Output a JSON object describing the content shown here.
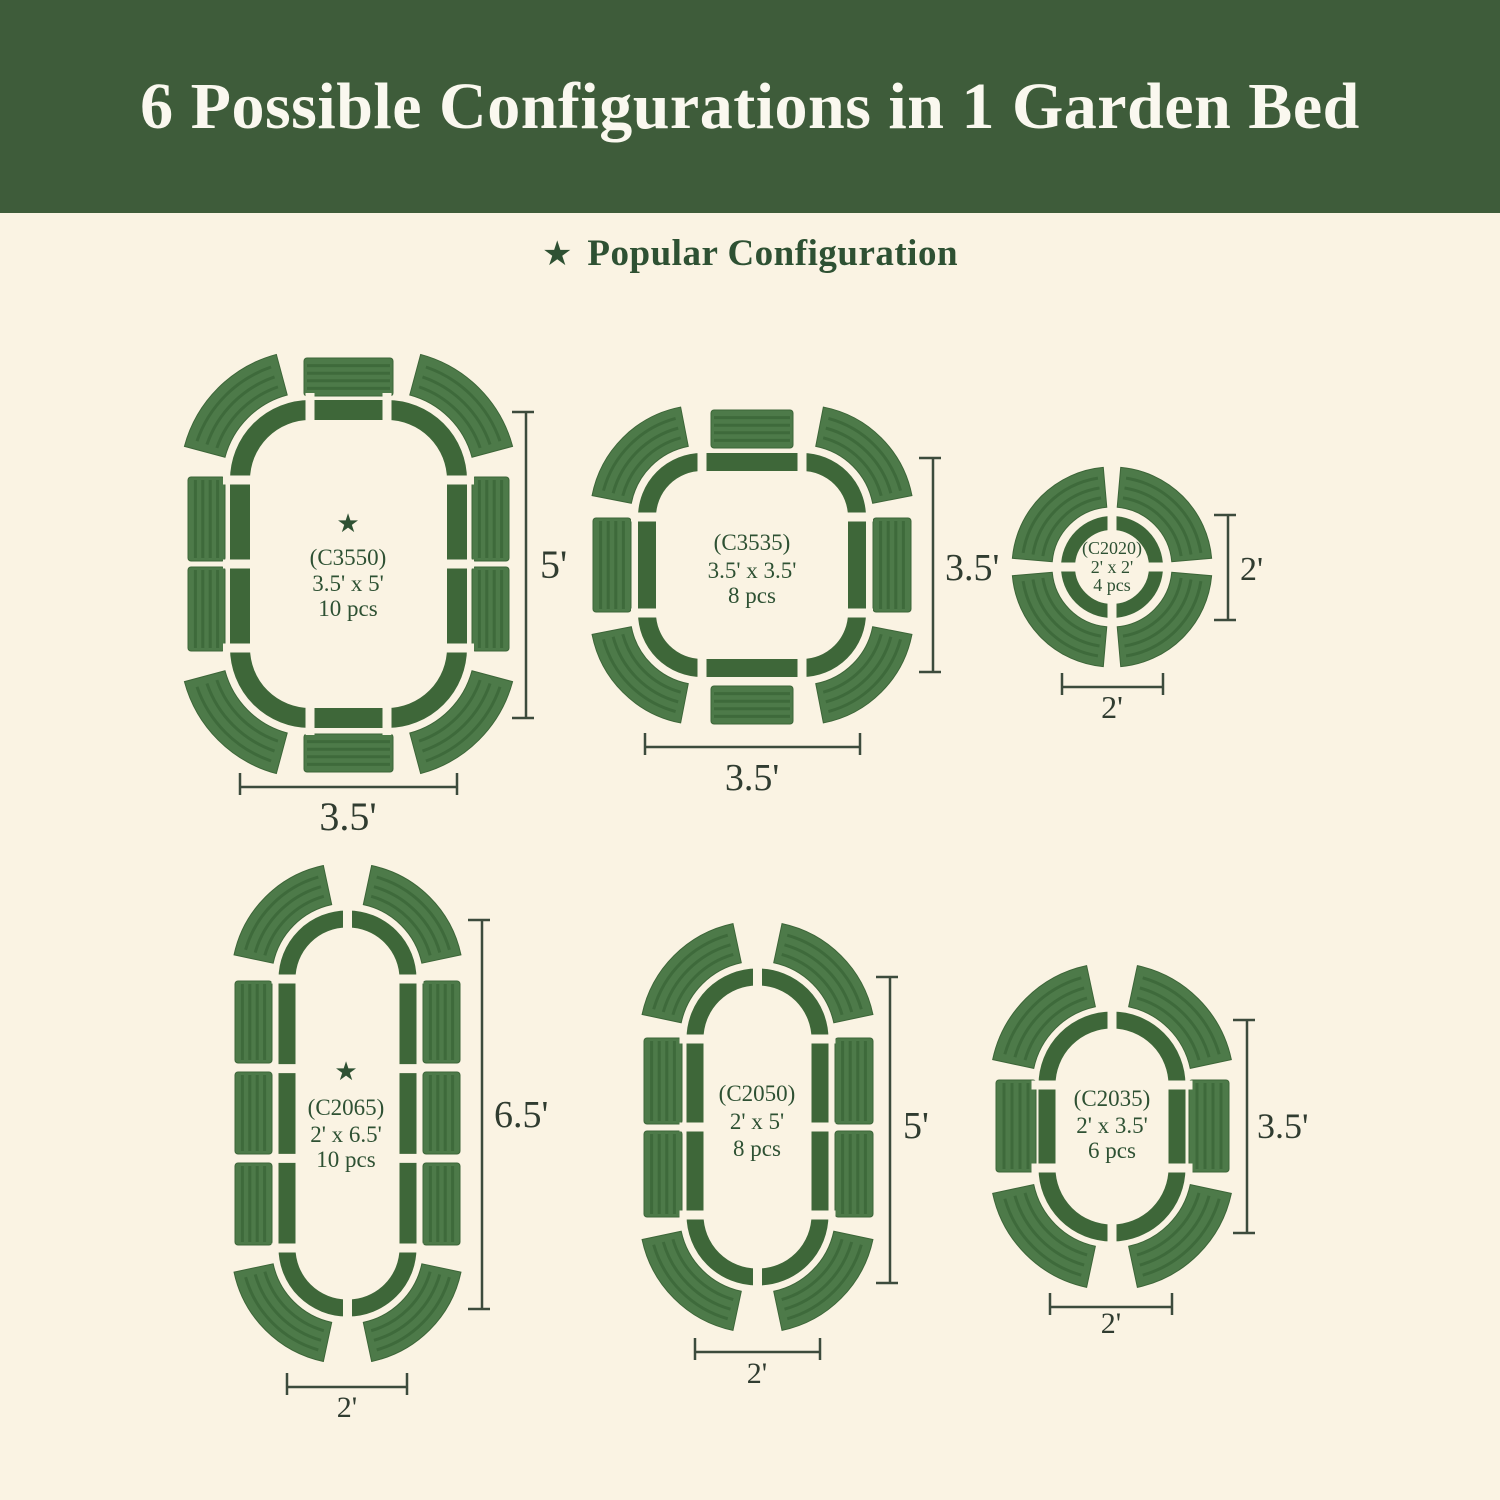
{
  "header": {
    "title": "6 Possible Configurations in 1 Garden Bed"
  },
  "legend": {
    "star_icon": "★",
    "label": "Popular Configuration"
  },
  "configs": [
    {
      "code": "(C3550)",
      "size": "3.5' x 5'",
      "pieces": "10 pcs",
      "popular": true,
      "height_dim": "5'",
      "width_dim": "3.5'"
    },
    {
      "code": "(C3535)",
      "size": "3.5' x 3.5'",
      "pieces": "8 pcs",
      "popular": false,
      "height_dim": "3.5'",
      "width_dim": "3.5'"
    },
    {
      "code": "(C2020)",
      "size": "2' x 2'",
      "pieces": "4 pcs",
      "popular": false,
      "height_dim": "2'",
      "width_dim": "2'"
    },
    {
      "code": "(C2065)",
      "size": "2' x 6.5'",
      "pieces": "10 pcs",
      "popular": true,
      "height_dim": "6.5'",
      "width_dim": "2'"
    },
    {
      "code": "(C2050)",
      "size": "2' x 5'",
      "pieces": "8 pcs",
      "popular": false,
      "height_dim": "5'",
      "width_dim": "2'"
    },
    {
      "code": "(C2035)",
      "size": "2' x 3.5'",
      "pieces": "6 pcs",
      "popular": false,
      "height_dim": "3.5'",
      "width_dim": "2'"
    }
  ],
  "colors": {
    "header_bg": "#3e5c3a",
    "header_text": "#faf8ef",
    "background": "#faf3e3",
    "bed_outline": "#3e6739",
    "panel": "#4d7a49",
    "panel_stripe": "#3e6a3b",
    "panel_edge": "#3c6538",
    "text_green": "#2e5133",
    "dim_text": "#303c30",
    "dim_line": "#3c4b3c"
  }
}
